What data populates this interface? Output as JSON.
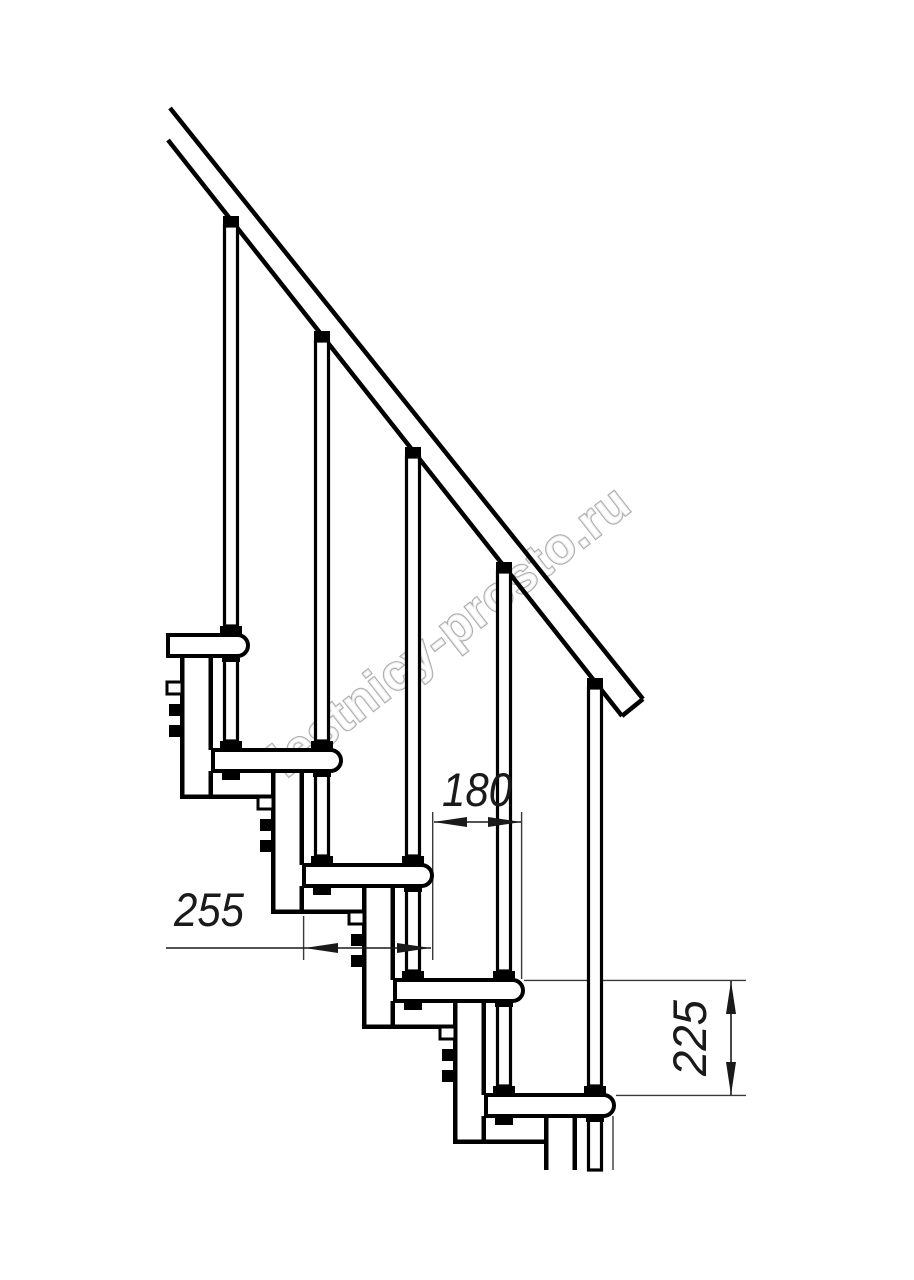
{
  "page": {
    "type": "staircase side-view technical drawing",
    "background_color": "#ffffff",
    "line_color": "#000000"
  },
  "watermark": {
    "text": "lestnicy-prosto.ru",
    "outline_color": "#adadad"
  },
  "dimensions": {
    "step_overlap_mm": "180",
    "tread_depth_mm": "255",
    "rise_height_mm": "225"
  }
}
